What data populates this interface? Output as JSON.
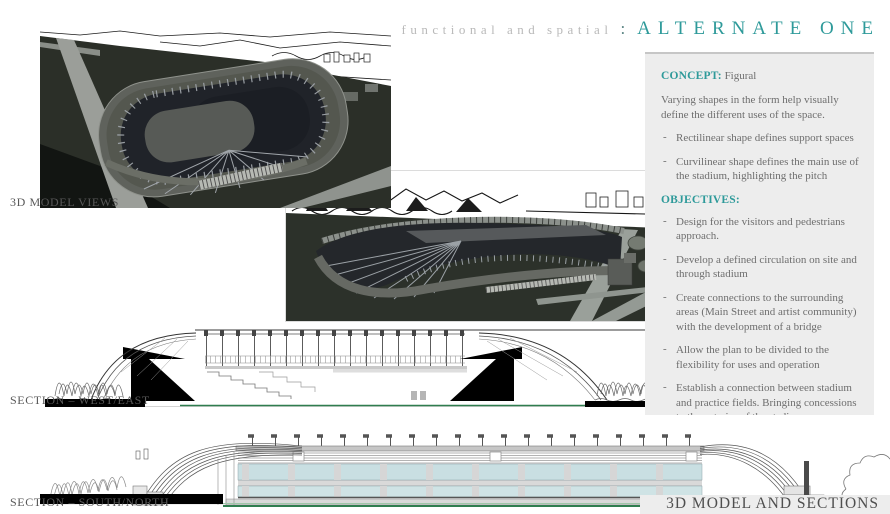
{
  "header": {
    "subtitle": "functional and spatial",
    "separator": ":",
    "title": "ALTERNATE ONE"
  },
  "labels": {
    "model_views": "3D MODEL VIEWS",
    "section_west_east": "SECTION – WEST/EAST",
    "section_south_north": "SECTION – SOUTH/NORTH",
    "footer": "3D MODEL AND SECTIONS"
  },
  "sidebar": {
    "dash": "-",
    "concept_label": "CONCEPT:",
    "concept_value": "Figural",
    "concept_intro": "Varying shapes in the form help visually define the different uses of the space.",
    "concept_points": [
      "Rectilinear shape defines support spaces",
      "Curvilinear shape defines the main use of the stadium, highlighting the pitch"
    ],
    "objectives_label": "OBJECTIVES:",
    "objectives": [
      "Design for the visitors and pedestrians approach.",
      "Develop a defined circulation on site and through stadium",
      "Create connections to the surrounding areas (Main Street and artist community) with the development of a bridge",
      "Allow the plan to be divided to the flexibility for uses and operation",
      "Establish a connection between stadium and practice fields.  Bringing concessions to the exterior of the stadium",
      "Respond to and incorporate existing and planned pedestrian infrastructure"
    ]
  },
  "colors": {
    "accent": "#2E9A9A",
    "header_muted": "#B9B9B9",
    "panel_bg": "#EDEDED",
    "panel_border": "#C6C6C6",
    "body_text": "#6E6E6E",
    "label_text": "#585858",
    "footer_text": "#4F4F4F",
    "glass_blue": "#C9DFE2",
    "site_green": "#2F7D4F"
  }
}
